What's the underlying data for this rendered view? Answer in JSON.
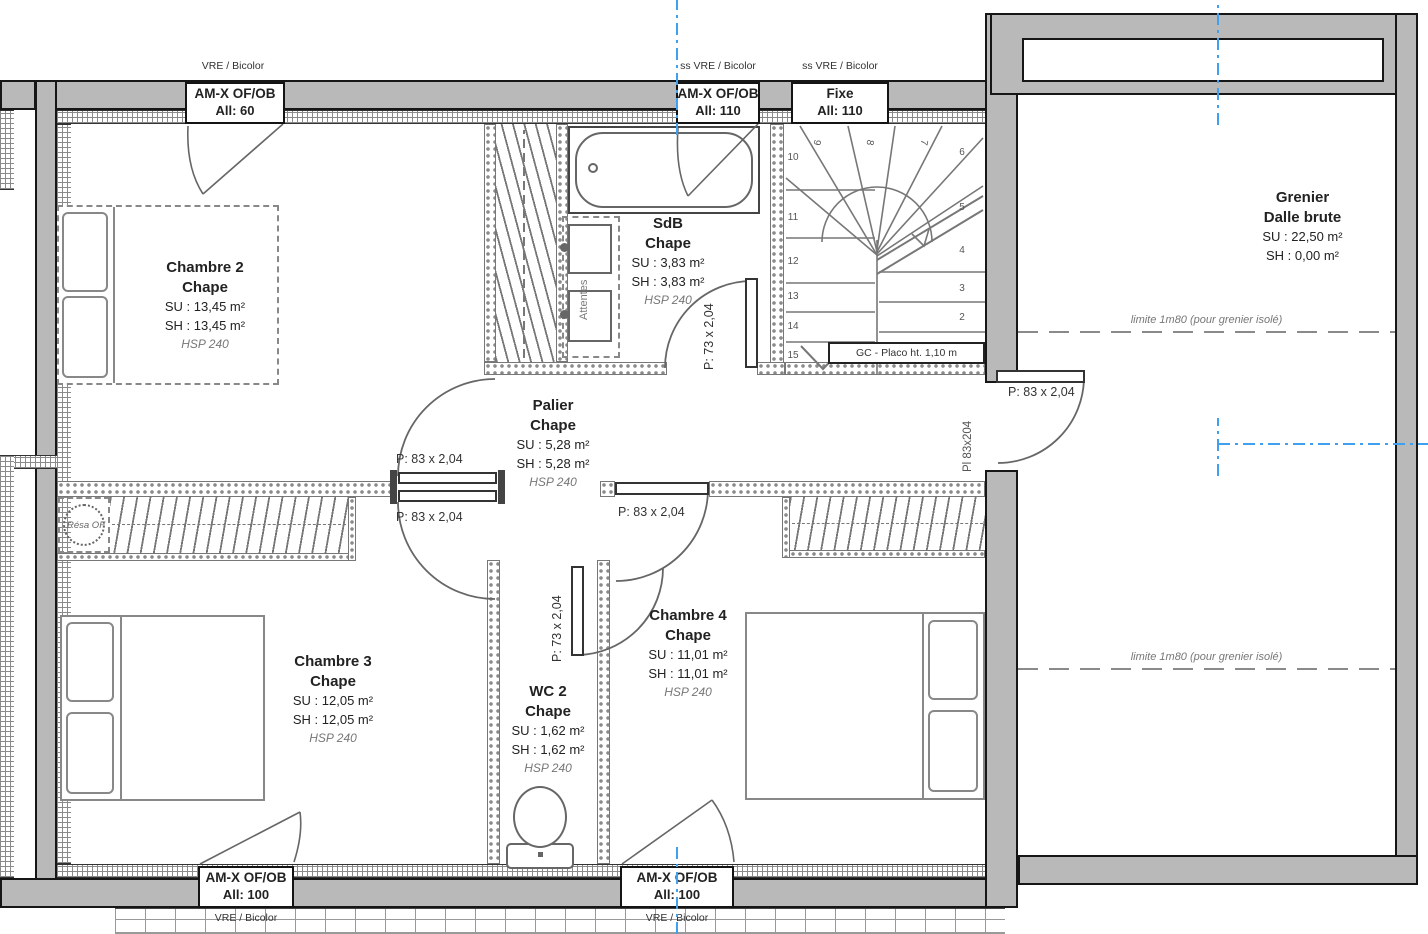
{
  "rooms": {
    "chambre2": {
      "name": "Chambre 2",
      "finish": "Chape",
      "su": "SU : 13,45 m²",
      "sh": "SH : 13,45 m²",
      "hsp": "HSP 240"
    },
    "chambre3": {
      "name": "Chambre 3",
      "finish": "Chape",
      "su": "SU : 12,05 m²",
      "sh": "SH : 12,05 m²",
      "hsp": "HSP 240"
    },
    "chambre4": {
      "name": "Chambre 4",
      "finish": "Chape",
      "su": "SU : 11,01 m²",
      "sh": "SH : 11,01 m²",
      "hsp": "HSP 240"
    },
    "sdb": {
      "name": "SdB",
      "finish": "Chape",
      "su": "SU : 3,83 m²",
      "sh": "SH : 3,83 m²",
      "hsp": "HSP 240"
    },
    "wc2": {
      "name": "WC 2",
      "finish": "Chape",
      "su": "SU : 1,62 m²",
      "sh": "SH : 1,62 m²",
      "hsp": "HSP 240"
    },
    "palier": {
      "name": "Palier",
      "finish": "Chape",
      "su": "SU : 5,28 m²",
      "sh": "SH : 5,28 m²",
      "hsp": "HSP 240"
    },
    "grenier": {
      "name": "Grenier",
      "finish": "Dalle brute",
      "su": "SU : 22,50 m²",
      "sh": "SH : 0,00 m²"
    }
  },
  "windows": {
    "top_left": {
      "head": "VRE / Bicolor",
      "type": "AM-X OF/OB",
      "allege": "All:  60"
    },
    "top_mid": {
      "head": "ss VRE / Bicolor",
      "type": "AM-X OF/OB",
      "allege": "All:  110"
    },
    "top_fixe": {
      "head": "ss VRE / Bicolor",
      "type": "Fixe",
      "allege": "All:  110"
    },
    "bottom_left": {
      "type": "AM-X OF/OB",
      "allege": "All:  100",
      "foot": "VRE / Bicolor"
    },
    "bottom_mid": {
      "type": "AM-X OF/OB",
      "allege": "All:  100",
      "foot": "VRE / Bicolor"
    }
  },
  "doors": {
    "p83": "P: 83 x 2,04",
    "p73": "P: 73 x 2,04",
    "pl": "Pl 83x204"
  },
  "annotations": {
    "limite": "limite 1m80 (pour grenier isolé)",
    "gc": "GC - Placo ht. 1,10 m",
    "resa": "Résa OF",
    "attentes": "Attentes"
  },
  "stairs": {
    "numbers": [
      "2",
      "3",
      "4",
      "5",
      "6",
      "7",
      "8",
      "9",
      "10",
      "11",
      "12",
      "13",
      "14",
      "15"
    ]
  },
  "colors": {
    "wall": "#b9b9b9",
    "line": "#666666",
    "centerline": "#3fa0f0"
  }
}
